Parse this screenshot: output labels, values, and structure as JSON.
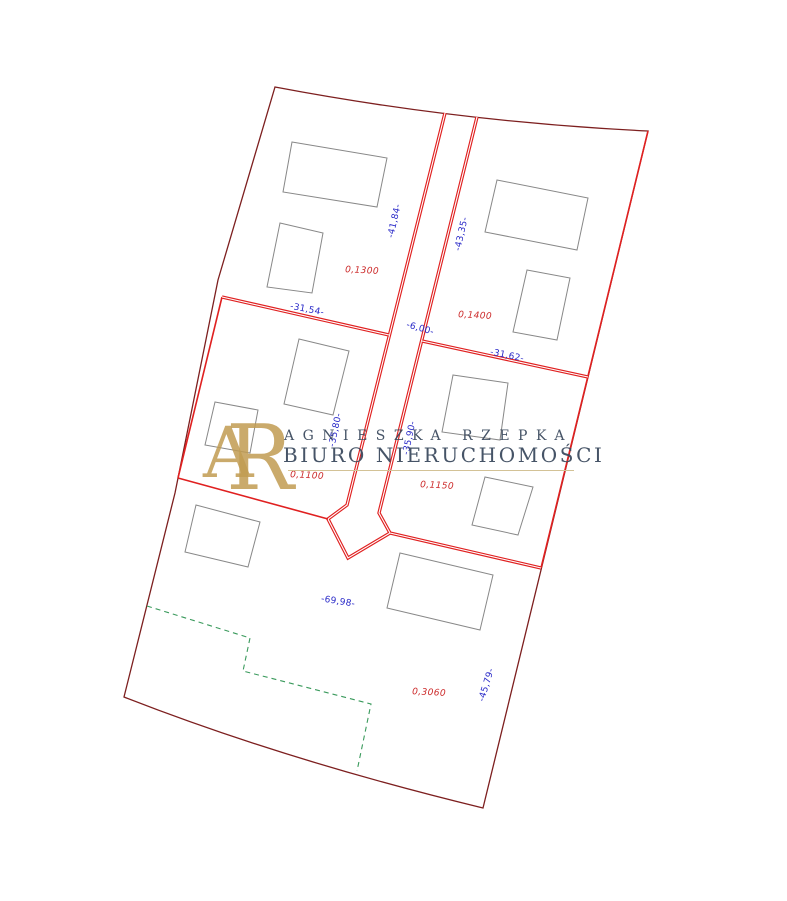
{
  "watermark": {
    "monogram_a": "A",
    "monogram_r": "R",
    "line1": "AGNIESZKA RZEPKA",
    "line2": "BIURO NIERUCHOMOŚCI"
  },
  "parcels": [
    {
      "id": "top-left",
      "area": "0,1300"
    },
    {
      "id": "top-right",
      "area": "0,1400"
    },
    {
      "id": "mid-left",
      "area": "0,1100"
    },
    {
      "id": "mid-right",
      "area": "0,1150"
    },
    {
      "id": "bottom",
      "area": "0,3060"
    }
  ],
  "dimensions": [
    {
      "edge": "road-west-upper",
      "text": "-41,84-"
    },
    {
      "edge": "road-east-upper",
      "text": "-43,35-"
    },
    {
      "edge": "divider-west",
      "text": "-31,54-"
    },
    {
      "edge": "road-width",
      "text": "-6,00-"
    },
    {
      "edge": "divider-east",
      "text": "-31,62-"
    },
    {
      "edge": "road-west-lower",
      "text": "-35,80-"
    },
    {
      "edge": "road-east-lower",
      "text": "-35,90-"
    },
    {
      "edge": "bottom-parcel-north",
      "text": "-69,98-"
    },
    {
      "edge": "bottom-parcel-east",
      "text": "-45,79-"
    }
  ],
  "colors": {
    "boundary": "#7d1f1f",
    "parcel_line": "#e02020",
    "building": "#888888",
    "dimension_text": "#2a2ac8",
    "area_text": "#cc2a2a",
    "green_dashed": "#3a9a5c",
    "watermark_text": "#3d4b5f",
    "watermark_gold": "#c19c52",
    "rule_gold": "#d3c296"
  }
}
